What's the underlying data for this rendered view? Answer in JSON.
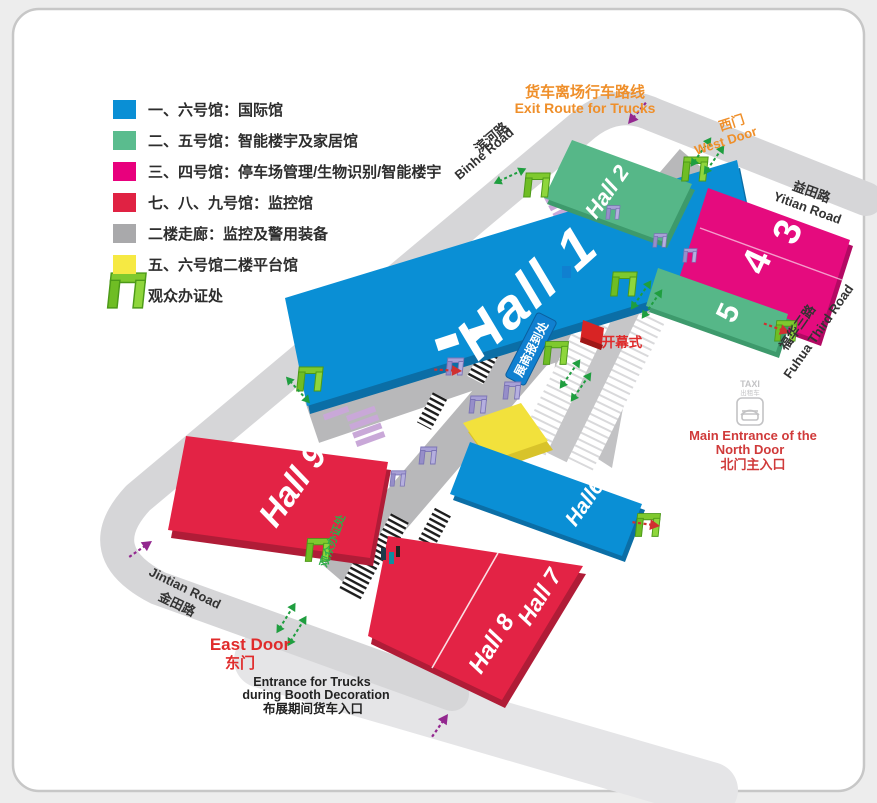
{
  "legend": {
    "items": [
      {
        "color": "#0a8fd5",
        "label": "一、六号馆：国际馆"
      },
      {
        "color": "#5abc8e",
        "label": "二、五号馆：智能楼宇及家居馆"
      },
      {
        "color": "#e8007d",
        "label": "三、四号馆：停车场管理/生物识别/智能楼宇"
      },
      {
        "color": "#e02243",
        "label": "七、八、九号馆：监控馆"
      },
      {
        "color": "#a9a9ab",
        "label": "二楼走廊：监控及警用装备"
      },
      {
        "color": "#f6e943",
        "label": "五、六号馆二楼平台馆"
      }
    ],
    "visitor_badge": "观众办证处"
  },
  "halls": {
    "h1": "Hall 1",
    "h2": "Hall 2",
    "h3": "3",
    "h4": "4",
    "h5": "5",
    "h6": "Hall6",
    "h7": "Hall 7",
    "h8": "Hall 8",
    "h9": "Hall 9"
  },
  "roads": {
    "binhe_cn": "滨河路",
    "binhe_en": "Binhe Road",
    "yitian_cn": "益田路",
    "yitian_en": "Yitian Road",
    "fuhua_cn": "福华三路",
    "fuhua_en": "Fuhua Third Road",
    "jintian_en": "Jintian Road",
    "jintian_cn": "金田路"
  },
  "doors": {
    "west_cn": "西门",
    "west_en": "West Door",
    "east_en": "East Door",
    "east_cn": "东门",
    "north_l1": "Main Entrance of the",
    "north_l2": "North Door",
    "north_l3": "北门主入口"
  },
  "annotations": {
    "truck_exit_cn": "货车离场行车路线",
    "truck_exit_en": "Exit Route for Trucks",
    "truck_in_l1": "Entrance for Trucks",
    "truck_in_l2": "during Booth Decoration",
    "truck_in_l3": "布展期间货车入口",
    "opening": "开幕式",
    "exhibitor_reg": "展商报到处",
    "corridor_badge": "观众办证处",
    "taxi_en": "TAXI",
    "taxi_cn": "出租车"
  },
  "colors": {
    "hall_blue": "#0a8fd5",
    "hall_blue_dark": "#0b6ea6",
    "hall_green": "#56b788",
    "hall_green_dark": "#3d9a6c",
    "hall_magenta": "#e50b7e",
    "hall_magenta_dark": "#b30963",
    "hall_red": "#e32345",
    "hall_red_dark": "#b01c37",
    "corridor": "#b8b8ba",
    "road": "#d6d6d8",
    "road_light": "#e5e5e7",
    "yellow": "#f2e13c",
    "yellow_dark": "#d8c32a",
    "gate_green": "#7fc92e",
    "gate_purple": "#a7a0d6",
    "crosswalk": "#c9a8d8",
    "orange_text": "#ef8f2a",
    "red_text": "#d03a3a",
    "green_text": "#2fae4a",
    "arrow_green": "#1f9e3f",
    "arrow_purple": "#93278f",
    "arrow_red": "#d03030",
    "banner_blue": "#1080d0",
    "flag_red": "#d82424"
  }
}
